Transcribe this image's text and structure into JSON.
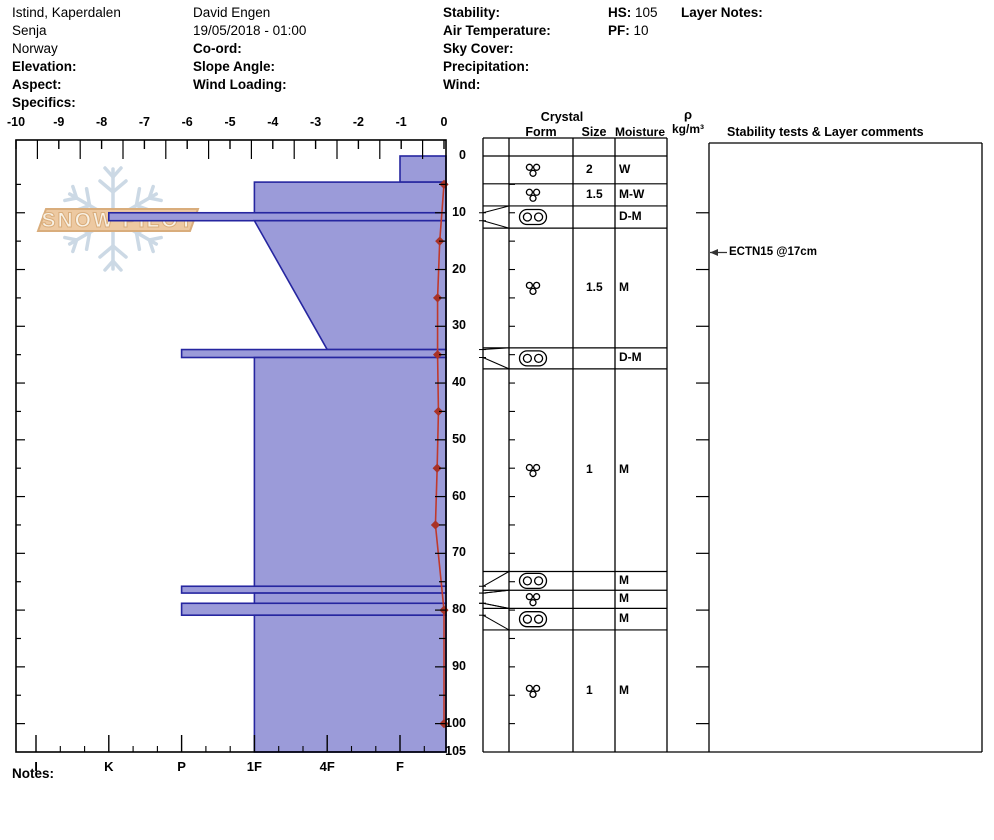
{
  "header": {
    "col1": {
      "location": "Istind, Kaperdalen",
      "region": "Senja",
      "country": "Norway",
      "elevation_label": "Elevation:",
      "aspect_label": "Aspect:",
      "specifics_label": "Specifics:"
    },
    "col2": {
      "observer": "David Engen",
      "datetime": "19/05/2018 - 01:00",
      "coord_label": "Co-ord:",
      "slope_angle_label": "Slope Angle:",
      "wind_loading_label": "Wind Loading:"
    },
    "col3": {
      "stability_label": "Stability:",
      "air_temperature_label": "Air Temperature:",
      "sky_cover_label": "Sky Cover:",
      "precipitation_label": "Precipitation:",
      "wind_label": "Wind:"
    },
    "col4": {
      "hs_label": "HS:",
      "hs_value": "105",
      "pf_label": "PF:",
      "pf_value": "10"
    },
    "col5": {
      "layer_notes_label": "Layer Notes:"
    }
  },
  "footer": {
    "notes_label": "Notes:"
  },
  "logo": {
    "text": "SNOW PILOT"
  },
  "chart_data": {
    "type": "snow-profile",
    "title": "Snow pit profile, Istind Kaperdalen, 19/05/2018",
    "hs_cm": 105,
    "pf_cm": 10,
    "temperature_axis": {
      "unit": "C",
      "range": [
        -10,
        0
      ],
      "tick_labels": [
        -10,
        -9,
        -8,
        -7,
        -6,
        -5,
        -4,
        -3,
        -2,
        -1,
        0
      ]
    },
    "hardness_axis": {
      "categories": [
        "I",
        "K",
        "P",
        "1F",
        "4F",
        "F"
      ]
    },
    "depth_axis": {
      "unit": "cm",
      "max": 105,
      "tick_labels": [
        0,
        10,
        20,
        30,
        40,
        50,
        60,
        70,
        80,
        90,
        100,
        105
      ]
    },
    "layers": [
      {
        "top_cm": 0,
        "bottom_cm": 4.6,
        "hardness": "F"
      },
      {
        "top_cm": 4.6,
        "bottom_cm": 10,
        "hardness": "1F"
      },
      {
        "top_cm": 10,
        "bottom_cm": 11.4,
        "hardness": "K"
      },
      {
        "top_cm": 11.4,
        "bottom_cm": 34.1,
        "hardness_top": "1F",
        "hardness_bottom": "4F"
      },
      {
        "top_cm": 34.1,
        "bottom_cm": 35.5,
        "hardness": "P"
      },
      {
        "top_cm": 35.5,
        "bottom_cm": 75.8,
        "hardness": "1F"
      },
      {
        "top_cm": 75.8,
        "bottom_cm": 77,
        "hardness": "P"
      },
      {
        "top_cm": 77,
        "bottom_cm": 78.8,
        "hardness": "1F"
      },
      {
        "top_cm": 78.8,
        "bottom_cm": 80.9,
        "hardness": "P"
      },
      {
        "top_cm": 80.9,
        "bottom_cm": 105,
        "hardness": "1F"
      }
    ],
    "temperature_series": {
      "depths_cm": [
        5,
        15,
        25,
        35,
        45,
        55,
        65,
        80,
        100
      ],
      "temps_c": [
        0,
        -0.1,
        -0.15,
        -0.15,
        -0.13,
        -0.16,
        -0.2,
        0,
        0
      ]
    },
    "grain_table": {
      "headers": {
        "crystal": "Crystal",
        "form": "Form",
        "size": "Size",
        "moisture": "Moisture",
        "density_rho": "ρ",
        "density_units": "kg/m³",
        "comments": "Stability tests & Layer comments"
      },
      "rows": [
        {
          "disp_top": 0,
          "disp_bottom": 4.9,
          "form": "MFcl",
          "size": "2",
          "moisture": "W"
        },
        {
          "disp_top": 4.9,
          "disp_bottom": 8.8,
          "form": "MFcl",
          "size": "1.5",
          "moisture": "M-W"
        },
        {
          "disp_top": 8.8,
          "disp_bottom": 12.7,
          "form": "MFcr",
          "size": "",
          "moisture": "D-M",
          "leader": true,
          "actual_top": 10,
          "actual_bottom": 11.4
        },
        {
          "disp_top": 12.7,
          "disp_bottom": 33.8,
          "form": "MFcl",
          "size": "1.5",
          "moisture": "M"
        },
        {
          "disp_top": 33.8,
          "disp_bottom": 37.5,
          "form": "MFcr",
          "size": "",
          "moisture": "D-M",
          "leader": true,
          "actual_top": 34.1,
          "actual_bottom": 35.5
        },
        {
          "disp_top": 37.5,
          "disp_bottom": 73.2,
          "form": "MFcl",
          "size": "1",
          "moisture": "M"
        },
        {
          "disp_top": 73.2,
          "disp_bottom": 76.5,
          "form": "MFcr",
          "size": "",
          "moisture": "M",
          "leader": true,
          "actual_top": 75.8,
          "actual_bottom": 77
        },
        {
          "disp_top": 76.5,
          "disp_bottom": 79.7,
          "form": "MFcl",
          "size": "",
          "moisture": "M",
          "leader": true,
          "actual_top": 77,
          "actual_bottom": 78.8
        },
        {
          "disp_top": 79.7,
          "disp_bottom": 83.5,
          "form": "MFcr",
          "size": "",
          "moisture": "M",
          "leader": true,
          "actual_top": 78.8,
          "actual_bottom": 80.9
        },
        {
          "disp_top": 83.5,
          "disp_bottom": 105,
          "form": "MFcl",
          "size": "1",
          "moisture": "M"
        }
      ]
    },
    "annotations": [
      {
        "text": "ECTN15 @17cm",
        "depth_cm": 17
      }
    ],
    "colors": {
      "layer_fill": "#9b9bd9",
      "layer_border": "#2626a0",
      "temp_line": "#c0392b",
      "temp_marker": "#a93226",
      "grid": "#000000",
      "logo_band": "#edc9a1",
      "logo_outline": "#d9ad7c",
      "logo_text": "#f8f1e4",
      "snowflake": "#ccd9e5"
    }
  }
}
